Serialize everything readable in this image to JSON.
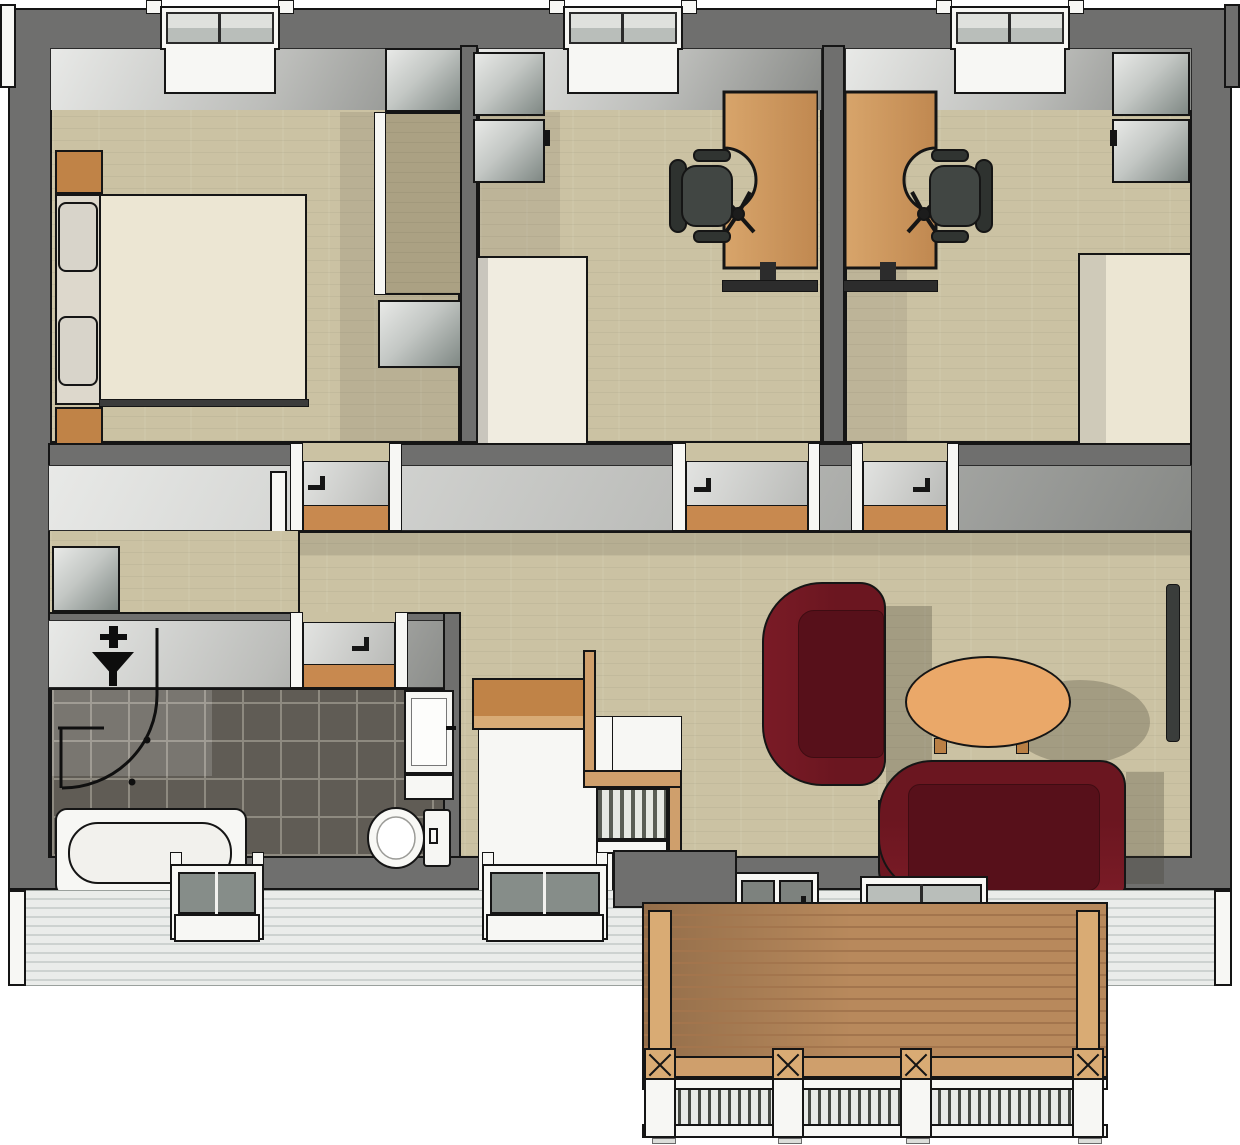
{
  "meta": {
    "kind": "3d-floor-plan-render",
    "view": "top-down axonometric apartment plan with deck",
    "rendered_text": "none"
  },
  "labels": {
    "bedroom": "bedroom",
    "office1": "office with desk and chair",
    "office2": "office with desk, chair and bed",
    "bathroom": "bathroom",
    "hallway": "hallway with staircase",
    "living": "living room",
    "deck": "wooden deck with railing"
  },
  "inventory": {
    "bedroom": [
      "double-bed",
      "pillow",
      "pillow",
      "nightstand",
      "nightstand",
      "closet-alcove",
      "dresser"
    ],
    "office1": [
      "metal-cabinet",
      "metal-cabinet",
      "white-dresser",
      "desk",
      "office-chair"
    ],
    "office2": [
      "desk",
      "office-chair",
      "metal-cabinet",
      "metal-cabinet",
      "single-bed"
    ],
    "bathroom": [
      "shower-enclosure",
      "shower-mixer",
      "bathtub",
      "toilet",
      "vanity-sink",
      "washing-machine"
    ],
    "hallway": [
      "stair-void",
      "console-shelf",
      "handrail",
      "baluster-rail",
      "open-door"
    ],
    "living": [
      "sofa",
      "sofa",
      "coffee-table",
      "radiator"
    ],
    "deck": [
      "deck-floor",
      "corner-post",
      "corner-post",
      "cross-brace-posts",
      "white-railing"
    ],
    "openings": {
      "top_windows": 3,
      "bottom_bay_windows": 2,
      "patio_door": 1,
      "living_window": 1,
      "interior_doors": 4
    }
  },
  "palette": {
    "ink": "#151515",
    "wall": "#6f6f6e",
    "face_hi": "#e8e9e7",
    "face_mid": "#bcbdba",
    "face_lo": "#878986",
    "floor": "#cbc2a3",
    "floor_dark": "#aba183",
    "tile": "#605c55",
    "grout": "#8e8a80",
    "wood_orange": "#c08347",
    "deck": "#b8895c",
    "deck_line": "#a3754d",
    "deck_post": "#d9ab74",
    "beam": "#cf9f6c",
    "cream": "#ece6d3",
    "cream2": "#f0ece0",
    "pillow": "#d8d4ca",
    "sofa": "#6b1620",
    "sofa_dark": "#57101a",
    "table": "#eaa869",
    "chair": "#414643",
    "chair_dark": "#2e322f",
    "metal_hi": "#e8e9e7",
    "metal_lo": "#7f8884",
    "white": "#f7f7f4",
    "glass": "#dfe1dd",
    "glass_mid": "#b9beba",
    "glass_dark": "#868d89",
    "siding": "#eaecea",
    "siding_line": "#cdd2d0",
    "threshold": "#c8894f",
    "shadow": "rgba(60,56,46,0.28)"
  }
}
